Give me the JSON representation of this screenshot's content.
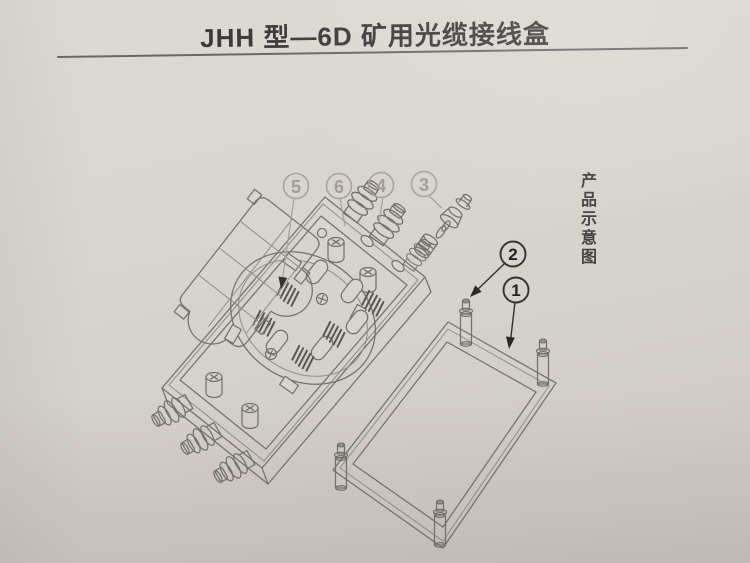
{
  "page": {
    "title": "JHH 型—6D 矿用光缆接线盒",
    "side_label": "产品示意图"
  },
  "diagram": {
    "callouts": [
      {
        "label": "1"
      },
      {
        "label": "2"
      },
      {
        "label": "3"
      },
      {
        "label": "4"
      },
      {
        "label": "5"
      },
      {
        "label": "6"
      }
    ]
  },
  "colors": {
    "paper": "#d6d2cd",
    "ink": "#3d3b38",
    "line": "#74716c",
    "faded_callout": "#a8a29a",
    "dark_callout": "#2f2d2a"
  }
}
